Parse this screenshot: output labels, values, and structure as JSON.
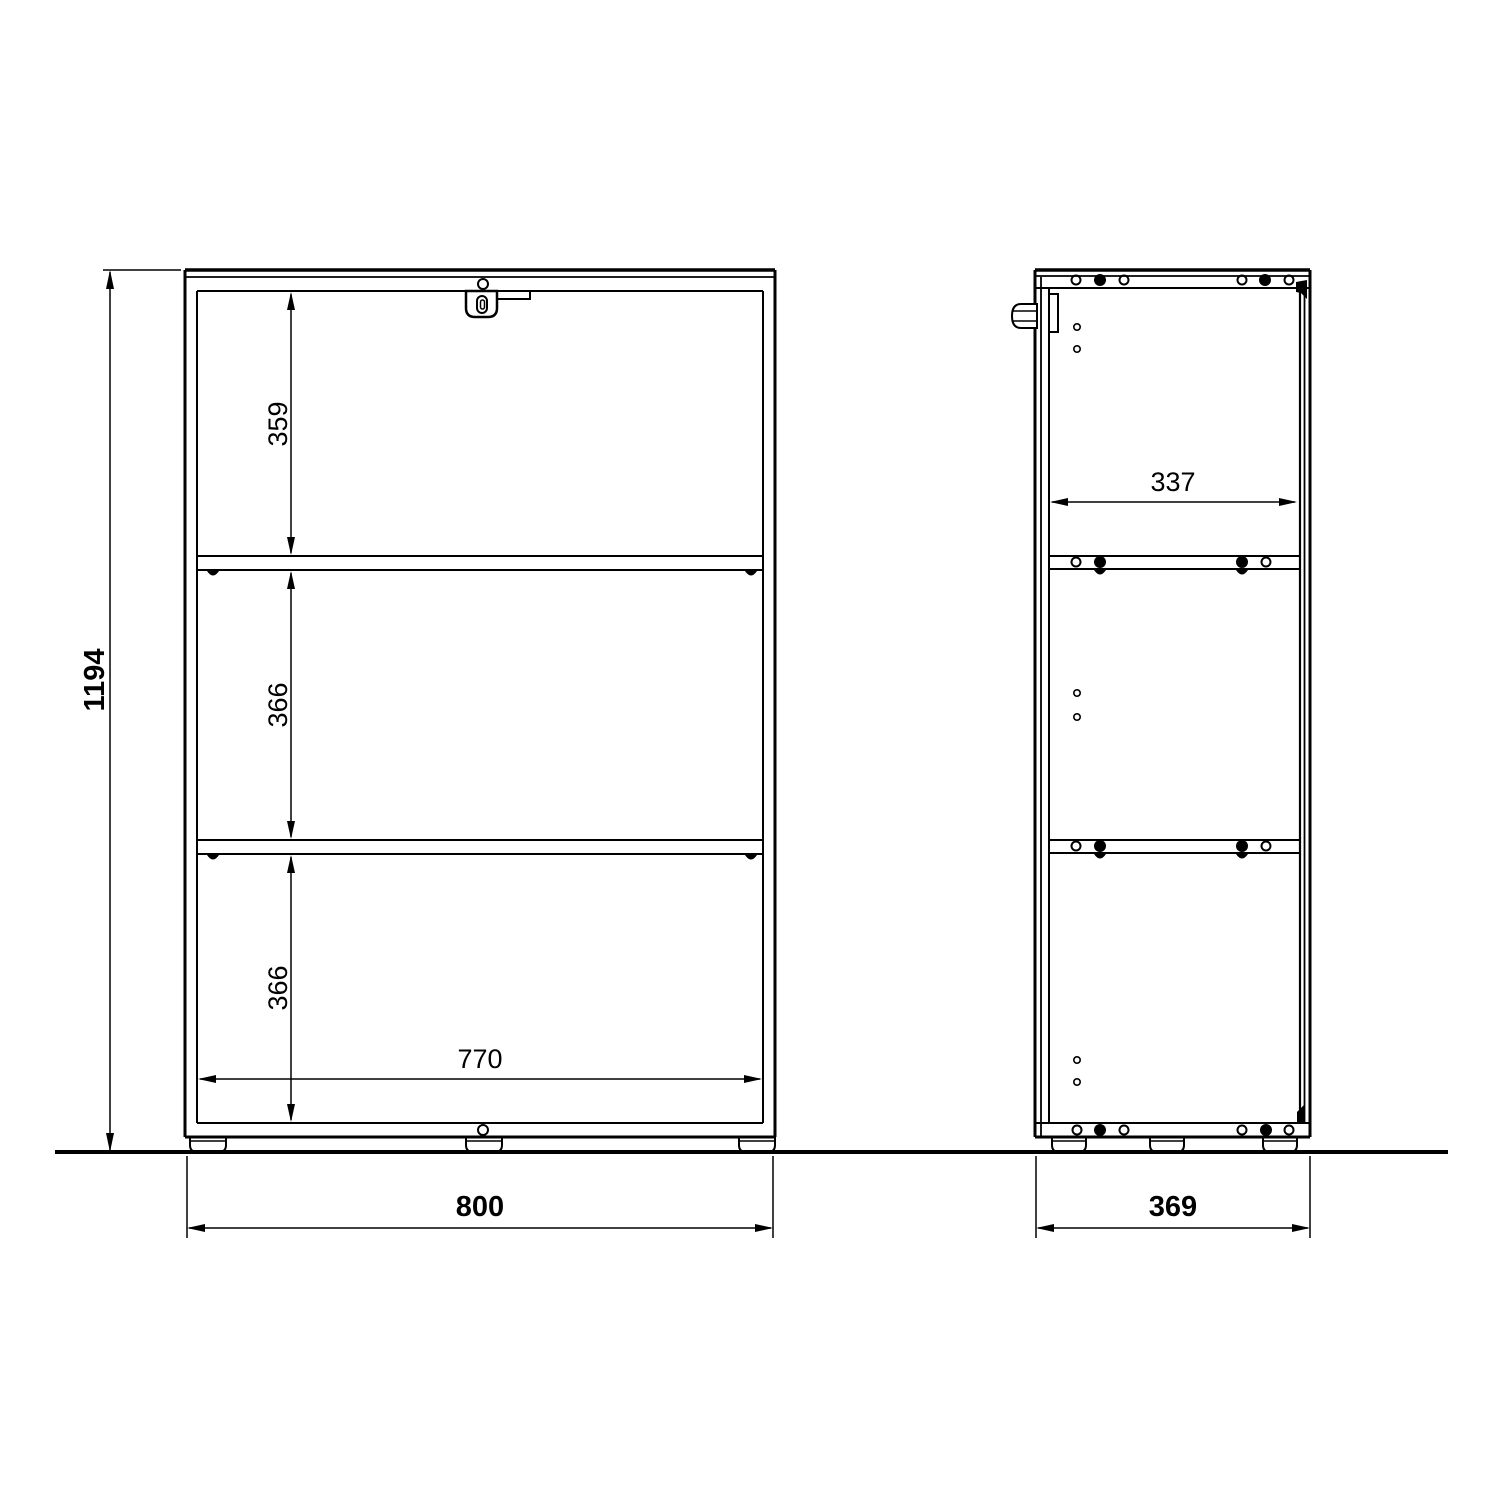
{
  "drawing": {
    "description": "Technical dimension drawing of a three-compartment cabinet, front view and side view",
    "background_color": "#ffffff",
    "line_color": "#000000",
    "views": {
      "front": {
        "name": "front elevation"
      },
      "side": {
        "name": "side elevation"
      }
    },
    "dimensions": {
      "overall_height": "1194",
      "overall_width": "800",
      "overall_depth": "369",
      "inner_width": "770",
      "inner_depth": "337",
      "compartment_top_height": "359",
      "compartment_middle_height": "366",
      "compartment_bottom_height": "366"
    }
  }
}
